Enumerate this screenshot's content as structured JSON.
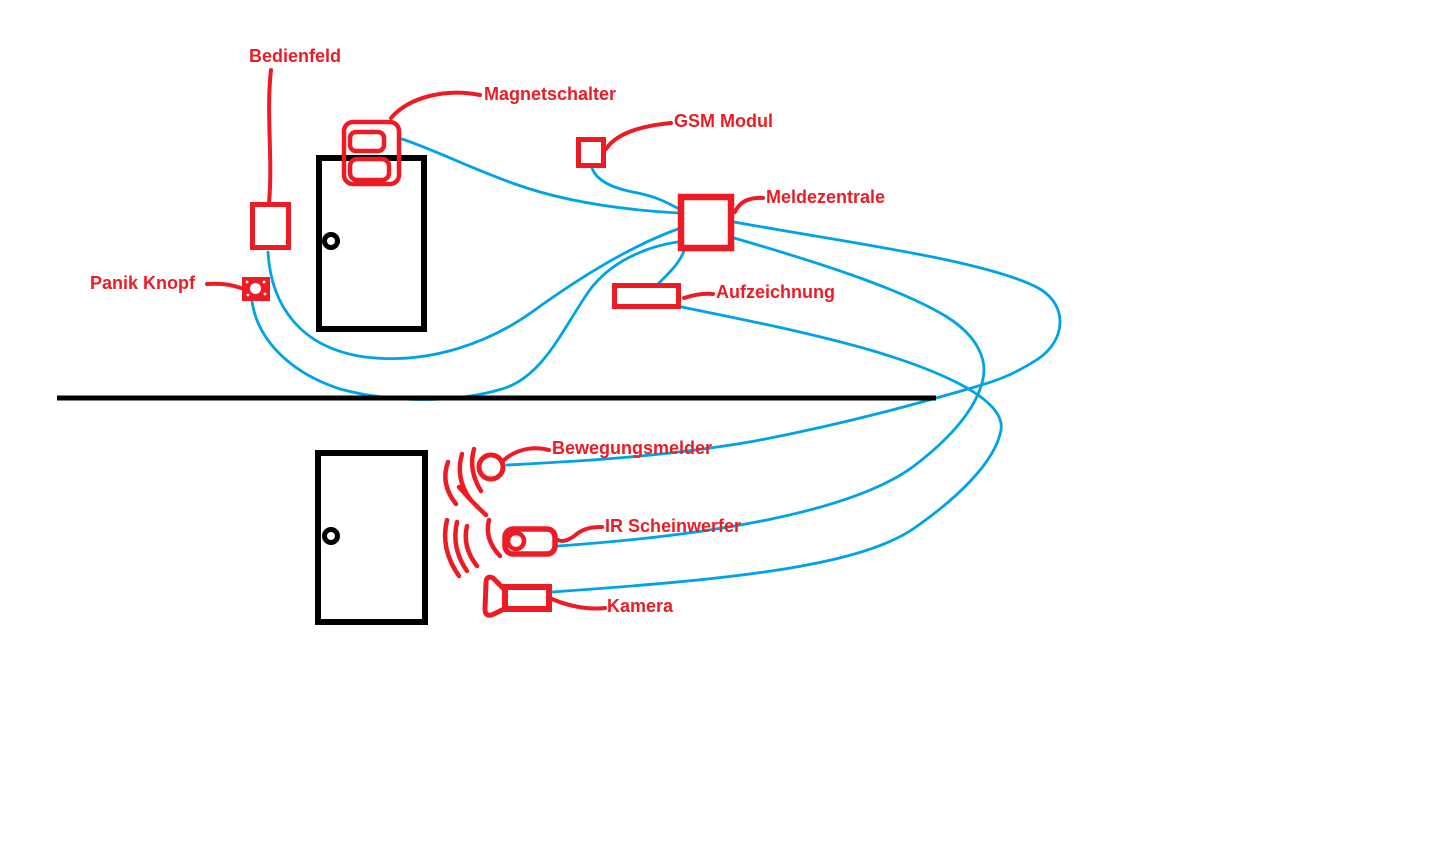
{
  "canvas": {
    "width": 1446,
    "height": 860,
    "background": "#ffffff"
  },
  "colors": {
    "annotation_red": "#ED1C24",
    "wire_blue": "#00A2E8",
    "structure_black": "#000000"
  },
  "labels": {
    "bedienfeld": {
      "text": "Bedienfeld"
    },
    "magnetschalter": {
      "text": "Magnetschalter"
    },
    "gsm": {
      "text": "GSM Modul"
    },
    "meldezentrale": {
      "text": "Meldezentrale"
    },
    "aufzeichnung": {
      "text": "Aufzeichnung"
    },
    "panik": {
      "text": "Panik Knopf"
    },
    "bewegungsmelder": {
      "text": "Bewegungsmelder"
    },
    "ir": {
      "text": "IR Scheinwerfer"
    },
    "kamera": {
      "text": "Kamera"
    }
  },
  "diagram": {
    "type": "hand-drawn wiring sketch (alarm system)",
    "components": [
      {
        "id": "bedienfeld",
        "label": "Bedienfeld",
        "shape": "red outlined square beside upper door"
      },
      {
        "id": "magnetschalter",
        "label": "Magnetschalter",
        "shape": "red double-contact switch straddling upper door top edge"
      },
      {
        "id": "gsm",
        "label": "GSM Modul",
        "shape": "small red outlined square"
      },
      {
        "id": "meldezentrale",
        "label": "Meldezentrale",
        "shape": "red outlined square (central unit)"
      },
      {
        "id": "aufzeichnung",
        "label": "Aufzeichnung",
        "shape": "red outlined wide rectangle"
      },
      {
        "id": "panik",
        "label": "Panik Knopf",
        "shape": "small filled red button with white center"
      },
      {
        "id": "bewegungsmelder",
        "label": "Bewegungsmelder",
        "shape": "red circle with radiating arcs"
      },
      {
        "id": "ir",
        "label": "IR Scheinwerfer",
        "shape": "red rounded cylinder with lens circle and arcs"
      },
      {
        "id": "kamera",
        "label": "Kamera",
        "shape": "red camera body with left-facing lens horn"
      }
    ],
    "structure": [
      {
        "id": "door-upper",
        "shape": "black door rectangle with knob (upper floor)"
      },
      {
        "id": "door-lower",
        "shape": "black door rectangle with knob (lower floor)"
      },
      {
        "id": "wall-line",
        "shape": "long horizontal black separator line"
      }
    ],
    "connections": [
      {
        "from": "magnetschalter",
        "to": "meldezentrale",
        "color": "blue"
      },
      {
        "from": "gsm",
        "to": "meldezentrale",
        "color": "blue"
      },
      {
        "from": "bedienfeld",
        "to": "meldezentrale",
        "color": "blue"
      },
      {
        "from": "panik",
        "to": "meldezentrale",
        "color": "blue"
      },
      {
        "from": "meldezentrale",
        "to": "aufzeichnung",
        "color": "blue"
      },
      {
        "from": "meldezentrale",
        "to": "bewegungsmelder",
        "color": "blue",
        "route": "far right loop crossing at right side"
      },
      {
        "from": "meldezentrale",
        "to": "ir",
        "color": "blue",
        "route": "through right-side crossing"
      },
      {
        "from": "aufzeichnung",
        "to": "kamera",
        "color": "blue",
        "route": "right-side loop"
      }
    ]
  }
}
